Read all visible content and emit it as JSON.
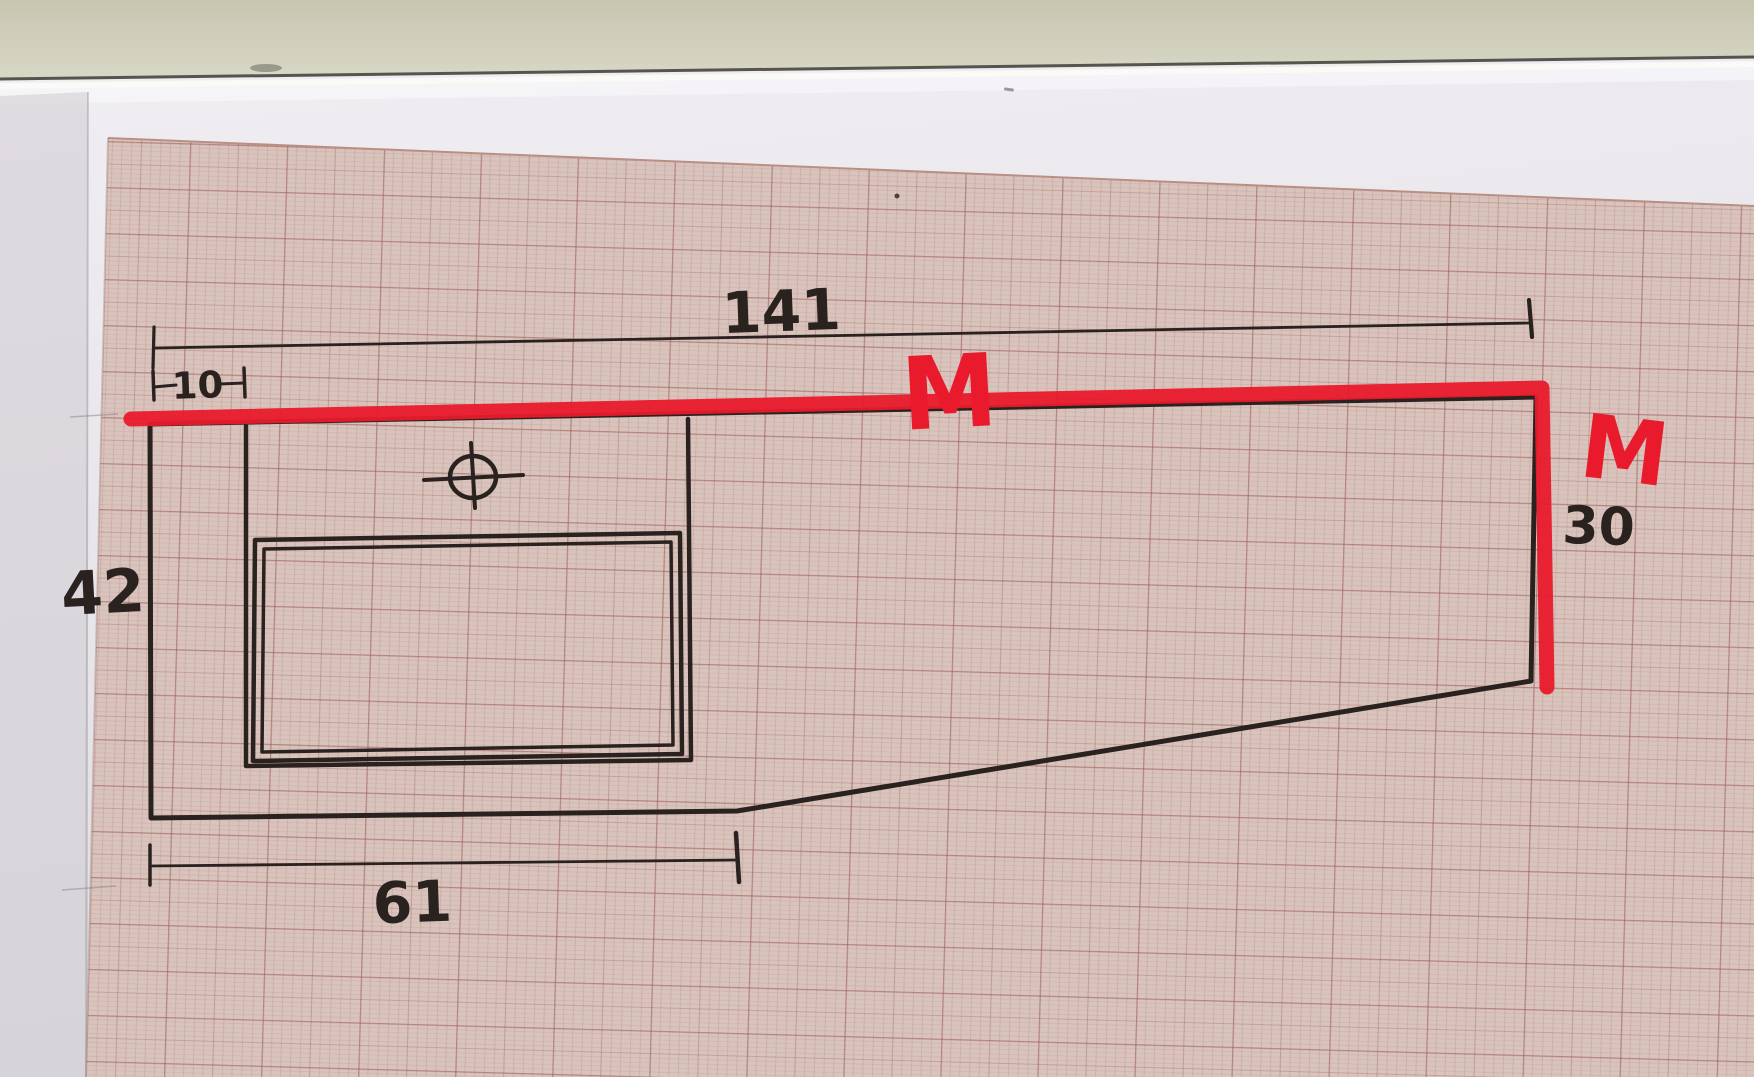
{
  "scene": {
    "description": "Photograph of a hand-drawn kitchen worktop sketch with dimensions, drawn in black ink on pink millimeter graph paper; the front edge is highlighted with a red marker and labelled M twice",
    "wall_color": "#c7c7b2",
    "paper_color": "#e9e7ec",
    "grid_sheet_color": "#d8c4bd",
    "grid_line_color": "#b2766c"
  },
  "sketch": {
    "ink_color": "#2a221f",
    "marker_color": "#e91a2c",
    "dimensions": {
      "top_width": "141",
      "left_inset": "10",
      "left_height": "42",
      "bottom_left_width": "61",
      "right_depth": "30"
    },
    "marker_labels": {
      "top_edge": "M",
      "right_edge": "M"
    }
  }
}
